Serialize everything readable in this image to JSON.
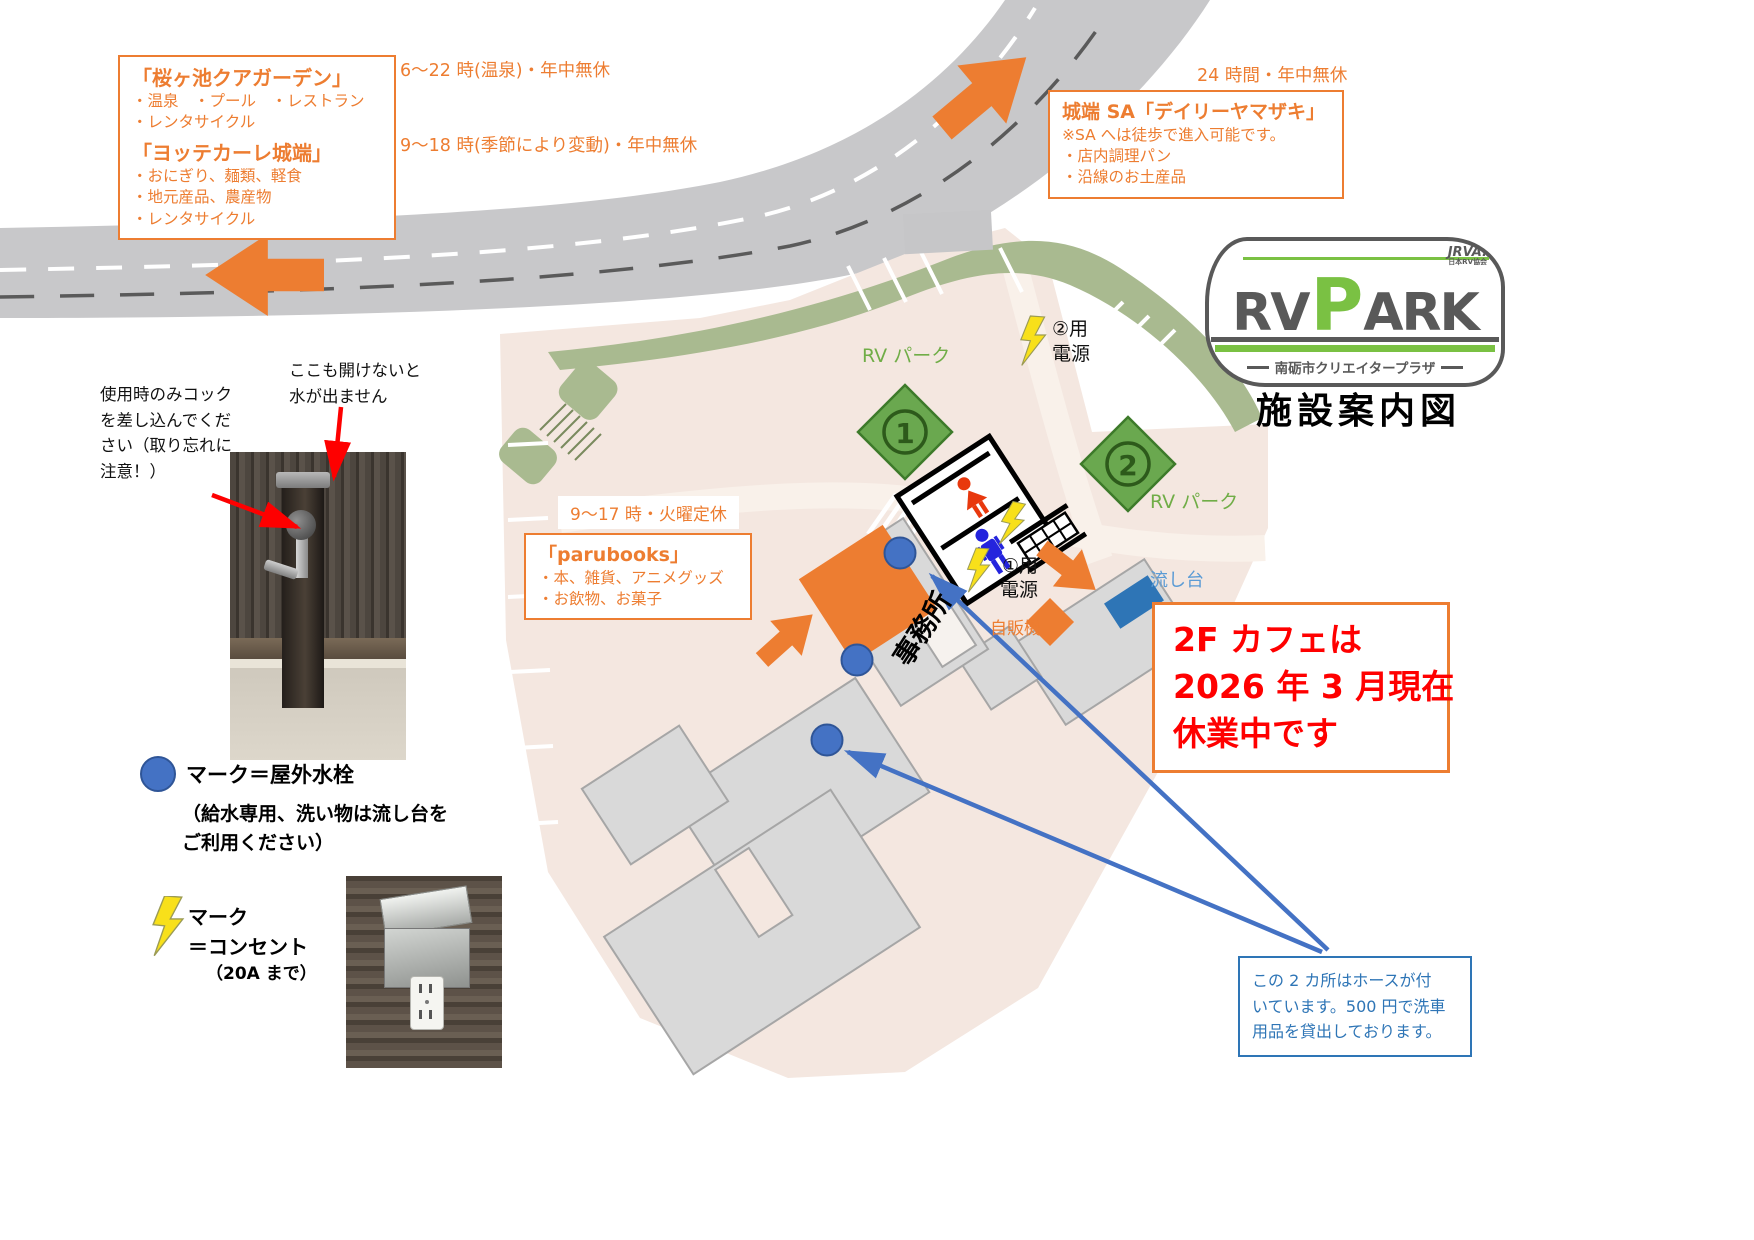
{
  "page_title": "施設案内図",
  "logo": {
    "brand_rv": "RV",
    "brand_p": "P",
    "brand_ark": "ARK",
    "subtitle": "南砺市クリエイタープラザ",
    "assoc": "JRVA.",
    "assoc_sub": "日本RV協会"
  },
  "quagarden": {
    "title": "「桜ヶ池クアガーデン」",
    "lines": [
      "・温泉　・プール　・レストラン",
      "・レンタサイクル"
    ],
    "hours": "6～22 時(温泉)・年中無休"
  },
  "yottekare": {
    "title": "「ヨッテカーレ城端」",
    "lines": [
      "・おにぎり、麺類、軽食",
      "・地元産品、農産物",
      "・レンタサイクル"
    ],
    "hours": "9～18 時(季節により変動)・年中無休"
  },
  "sa": {
    "hours": "24 時間・年中無休",
    "title": "城端 SA「デイリーヤマザキ」",
    "note": "※SA へは徒歩で進入可能です。",
    "lines": [
      "・店内調理パン",
      "・沿線のお土産品"
    ]
  },
  "parubooks": {
    "hours": "9～17 時・火曜定休",
    "title": "「parubooks」",
    "lines": [
      "・本、雑貨、アニメグッズ",
      "・お飲物、お菓子"
    ]
  },
  "tap_note_left": [
    "使用時のみコック",
    "を差し込んでくだ",
    "さい（取り忘れに",
    "注意！）"
  ],
  "tap_note_right": [
    "ここも開けないと",
    "水が出ません"
  ],
  "map": {
    "rv_park_label_1": "RV パーク",
    "rv_park_label_2": "RV パーク",
    "spot1": "1",
    "spot2": "2",
    "power2_line1": "②用",
    "power2_line2": "電源",
    "power1_line1": "①用",
    "power1_line2": "電源",
    "office": "事務所",
    "vending": "自販機",
    "sink": "流し台"
  },
  "closure": [
    "2F カフェは",
    "2026 年 3 月現在",
    "休業中です"
  ],
  "hose_note": [
    "この 2 カ所はホースが付",
    "いています。500 円で洗車",
    "用品を貸出しております。"
  ],
  "legend_water": {
    "label": "マーク＝屋外水栓",
    "sub": [
      "（給水専用、洗い物は流し台を",
      "ご利用ください）"
    ]
  },
  "legend_outlet": {
    "label": "マーク",
    "label2": "＝コンセント",
    "sub": "（20A まで）"
  },
  "colors": {
    "accent_orange": "#ed7d31",
    "map_pink": "#f4e7e0",
    "road_gray": "#c8c8ca",
    "green_strip": "#a9ba90",
    "rv_green": "#70ad47",
    "water_blue": "#4472c4",
    "sink_blue": "#2e75b6",
    "alert_red": "#ff0000",
    "bolt_yellow": "#f8e01a",
    "logo_green": "#7ac143",
    "logo_gray": "#595959"
  }
}
